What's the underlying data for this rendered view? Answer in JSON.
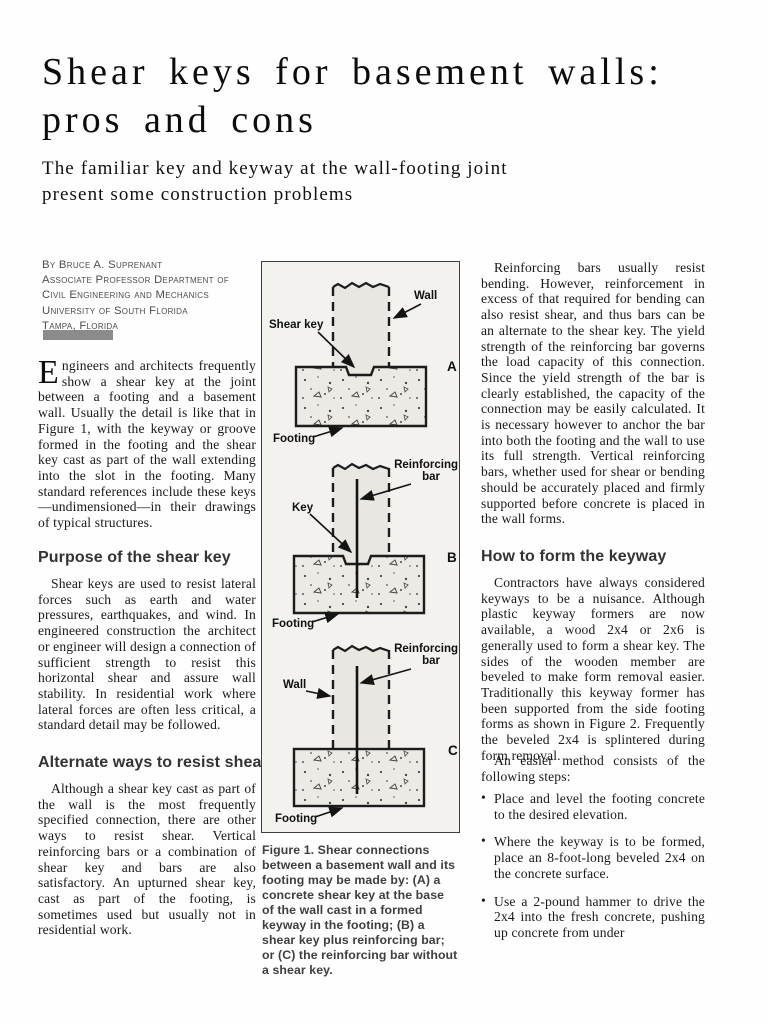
{
  "article": {
    "title_line1": "Shear keys for basement walls:",
    "title_line2": "pros and cons",
    "subtitle_line1": "The familiar key and keyway at the wall-footing joint",
    "subtitle_line2": "present some construction problems"
  },
  "byline": {
    "line1": "By Bruce A. Suprenant",
    "line2": "Associate Professor Department of",
    "line3": "Civil Engineering and Mechanics",
    "line4": "University of South Florida",
    "line5": "Tampa, Florida"
  },
  "left_column": {
    "dropcap": "E",
    "intro": "ngineers and architects frequently show a shear key at the joint between a footing and a basement wall. Usually the detail is like that in Figure 1, with the keyway or groove formed in the footing and the shear key cast as part of the wall extending into the slot in the footing. Many standard references include these keys—undimensioned—in their drawings of typical structures.",
    "heading1": "Purpose of the shear key",
    "para1": "Shear keys are used to resist lateral forces such as earth and water pressures, earthquakes, and wind. In engineered construction the architect or engineer will design a connection of sufficient strength to resist this horizontal shear and assure wall stability. In residential work where lateral forces are often less critical, a standard detail may be followed.",
    "heading2": "Alternate ways to resist shear",
    "para2": "Although a shear key cast as part of the wall is the most frequently specified connection, there are other ways to resist shear. Vertical reinforcing bars or a combination of shear key and bars are also satisfactory. An upturned shear key, cast as part of the footing, is sometimes used but usually not in residential work."
  },
  "right_column": {
    "para1": "Reinforcing bars usually resist bending. However, reinforcement in excess of that required for bending can also resist shear, and thus bars can be an alternate to the shear key. The yield strength of the reinforcing bar governs the load capacity of this connection. Since the yield strength of the bar is clearly established, the capacity of the connection may be easily calculated. It is necessary however to anchor the bar into both the footing and the wall to use its full strength. Vertical reinforcing bars, whether used for shear or bending should be accurately placed and firmly supported before concrete is placed in the wall forms.",
    "heading": "How to form the keyway",
    "para2": "Contractors have always considered keyways to be a nuisance. Although plastic keyway formers are now available, a wood 2x4 or 2x6 is generally used to form a shear key. The sides of the wooden member are beveled to make form removal easier. Traditionally this keyway former has been supported from the side footing forms as shown in Figure 2. Frequently the beveled 2x4 is splintered during form removal.",
    "para3": "An easier method consists of the following steps:",
    "bullet1": "Place and level the footing concrete to the desired elevation.",
    "bullet2": "Where the keyway is to be formed, place an 8-foot-long beveled 2x4 on the concrete surface.",
    "bullet3": "Use a 2-pound hammer to drive the 2x4 into the fresh concrete, pushing up concrete from under"
  },
  "figure": {
    "caption": "Figure 1. Shear connections between a basement wall and its footing may be made by: (A) a concrete shear key at the base of the wall cast in a formed keyway in the footing; (B) a shear key plus reinforcing bar; or (C) the reinforcing bar without a shear key.",
    "diagram_a": {
      "letter": "A",
      "label_shear_key": "Shear key",
      "label_wall": "Wall",
      "label_footing": "Footing"
    },
    "diagram_b": {
      "letter": "B",
      "label_bar_line1": "Reinforcing",
      "label_bar_line2": "bar",
      "label_key": "Key",
      "label_footing": "Footing"
    },
    "diagram_c": {
      "letter": "C",
      "label_bar_line1": "Reinforcing",
      "label_bar_line2": "bar",
      "label_wall": "Wall",
      "label_footing": "Footing"
    }
  },
  "colors": {
    "byline_bar": "#8b8b8b",
    "figure_background": "#f3f2ee",
    "text": "#161616"
  }
}
